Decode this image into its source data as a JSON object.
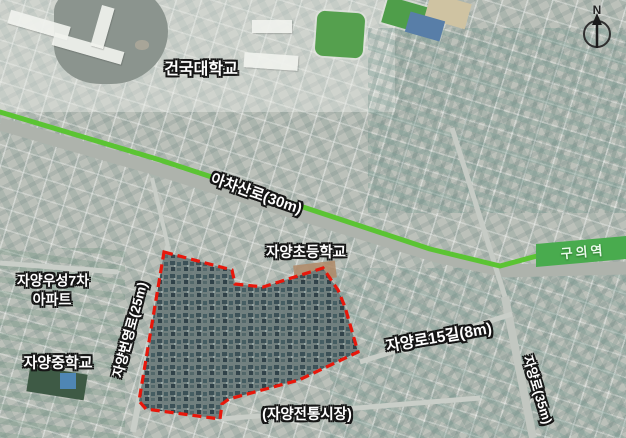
{
  "map": {
    "labels": {
      "university": "건국대학교",
      "main_road": "아차산로(30m)",
      "station": "구의역",
      "elementary_school": "자양초등학교",
      "apartment_line1": "자양우성7차",
      "apartment_line2": "아파트",
      "middle_school": "자양중학교",
      "west_road": "자양번영로(25m)",
      "south_road": "자양로15길(8m)",
      "east_road": "자양로(35m)",
      "market": "(자양전통시장)"
    },
    "compass": {
      "north_label": "N"
    },
    "colors": {
      "highlight_road": "#5bc433",
      "station_band": "#49ab4e",
      "boundary": "#e8170b",
      "lake": "#8b948e"
    }
  }
}
